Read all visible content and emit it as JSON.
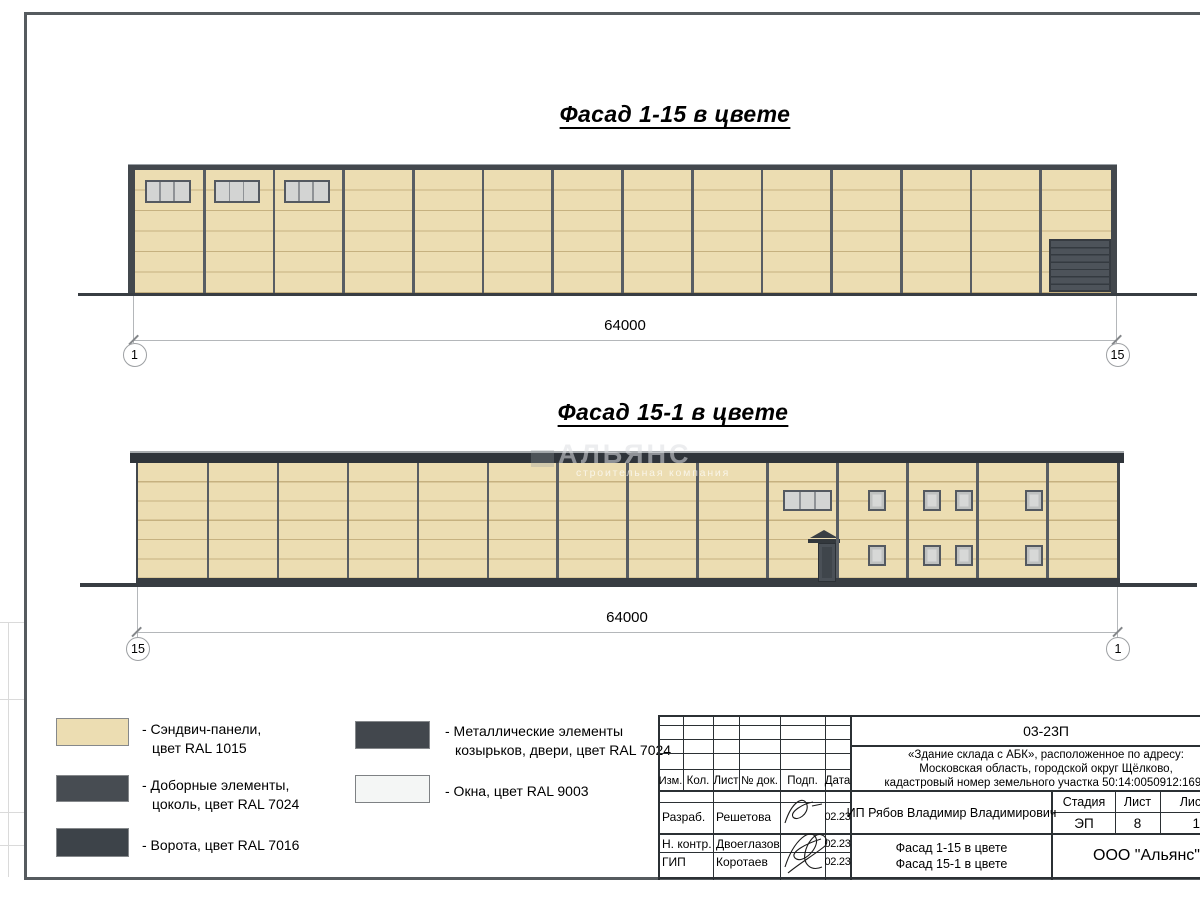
{
  "facade1": {
    "title": "Фасад 1-15 в цвете",
    "length": "64000",
    "axis_left": "1",
    "axis_right": "15",
    "bays": 14,
    "window_bays": [
      0,
      1,
      2
    ]
  },
  "facade2": {
    "title": "Фасад 15-1 в цвете",
    "length": "64000",
    "axis_left": "15",
    "axis_right": "1",
    "bays": 14
  },
  "watermark": {
    "name": "АЛЬЯНС",
    "tagline": "строительная компания"
  },
  "colors": {
    "sandwich_ral1015": "#ECDDB2",
    "elements_ral7024": "#474C52",
    "gate_ral7016": "#3D4349",
    "metal_ral7024": "#42474D",
    "windows_ral9003": "#F4F6F5"
  },
  "legend": {
    "items": [
      {
        "swatch": "#ECDDB2",
        "line1": "- Сэндвич-панели,",
        "line2": "цвет RAL 1015"
      },
      {
        "swatch": "#474C52",
        "line1": "- Доборные элементы,",
        "line2": "цоколь, цвет RAL 7024"
      },
      {
        "swatch": "#3D4349",
        "line1": "- Ворота, цвет RAL 7016",
        "line2": ""
      },
      {
        "swatch": "#42474D",
        "line1": "- Металлические элементы",
        "line2": "козырьков, двери, цвет RAL 7024"
      },
      {
        "swatch": "#F4F6F5",
        "line1": "- Окна, цвет RAL 9003",
        "line2": ""
      }
    ]
  },
  "stamp": {
    "doc_code": "03-23П",
    "address_line1": "«Здание склада с АБК», расположенное по адресу:",
    "address_line2": "Московская область, городской округ Щёлково,",
    "address_line3": "кадастровый номер земельного участка 50:14:0050912:1696",
    "col_izm": "Изм.",
    "col_kol": "Кол.",
    "col_list": "Лист",
    "col_ndok": "№ док.",
    "col_podp": "Подп.",
    "col_data": "Дата",
    "row1_role": "Разраб.",
    "row1_name": "Решетова",
    "row1_date": "02.23",
    "row2_role": "Н. контр.",
    "row2_name": "Двоеглазов",
    "row2_date": "02.23",
    "row3_role": "ГИП",
    "row3_name": "Коротаев",
    "row3_date": "02.23",
    "client": "ИП Рябов Владимир Владимирович",
    "stage_label": "Стадия",
    "sheet_label": "Лист",
    "sheets_label": "Листов",
    "stage": "ЭП",
    "sheet_no": "8",
    "sheets_total": "17",
    "subject_line1": "Фасад 1-15 в цвете",
    "subject_line2": "Фасад 15-1 в цвете",
    "company": "ООО \"Альянс\""
  }
}
